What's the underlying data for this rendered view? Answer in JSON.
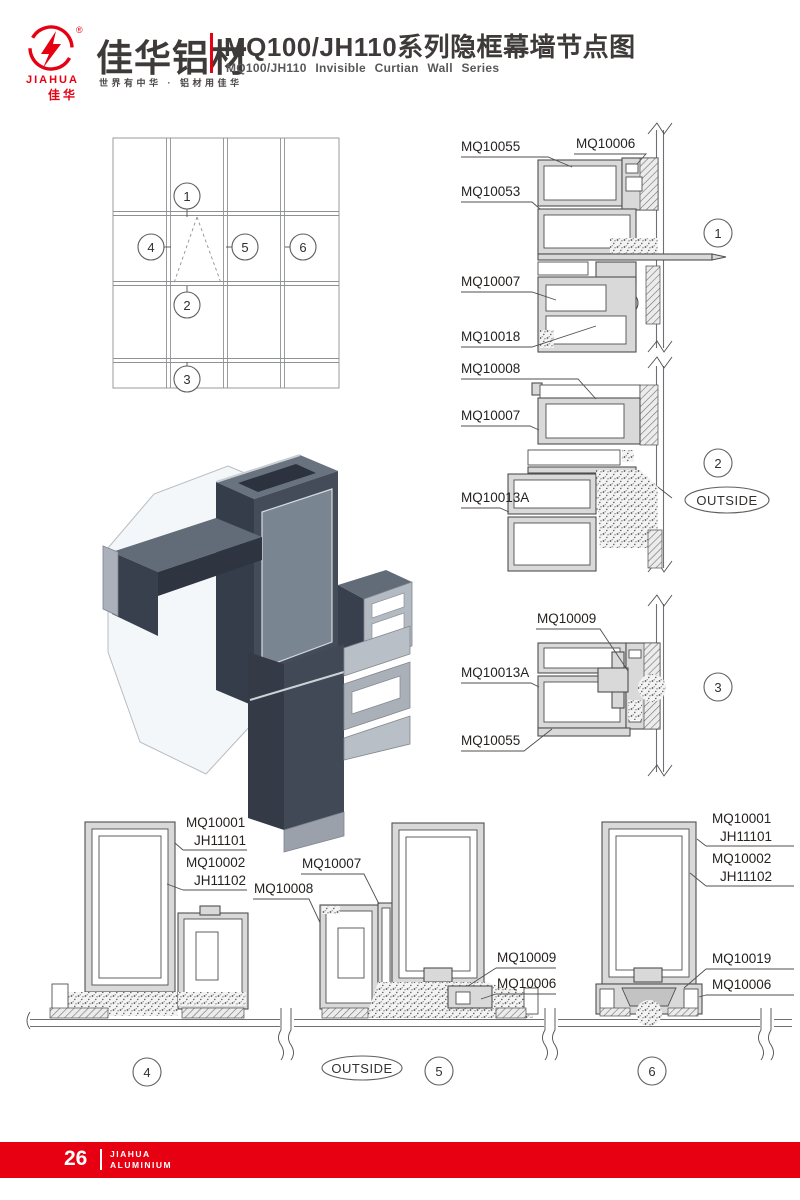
{
  "header": {
    "logo": {
      "brand_en": "JIAHUA",
      "brand_cn": "佳华",
      "registered": "®"
    },
    "brand_title": "佳华铝材",
    "brand_tagline": "世界有中华 · 铝材用佳华",
    "page_title": "MQ100/JH110系列隐框幕墙节点图",
    "page_subtitle": "MQ100/JH110 Invisible Curtian Wall Series"
  },
  "elevation": {
    "callouts": [
      "1",
      "2",
      "3",
      "4",
      "5",
      "6"
    ]
  },
  "details": {
    "d1": {
      "number": "1",
      "labels": [
        "MQ10055",
        "MQ10006",
        "MQ10053",
        "MQ10007",
        "MQ10018"
      ]
    },
    "d2": {
      "number": "2",
      "outside": "OUTSIDE",
      "labels": [
        "MQ10008",
        "MQ10007",
        "MQ10013A"
      ]
    },
    "d3": {
      "number": "3",
      "labels": [
        "MQ10009",
        "MQ10013A",
        "MQ10055"
      ]
    },
    "d4": {
      "number": "4",
      "labels": [
        "MQ10001",
        "JH11101",
        "MQ10002",
        "JH11102",
        "MQ10008"
      ]
    },
    "d5": {
      "number": "5",
      "outside": "OUTSIDE",
      "labels": [
        "MQ10007",
        "MQ10009",
        "MQ10006"
      ]
    },
    "d6": {
      "number": "6",
      "labels": [
        "MQ10001",
        "JH11101",
        "MQ10002",
        "JH11102",
        "MQ10019",
        "MQ10006"
      ]
    }
  },
  "footer": {
    "page_number": "26",
    "brand_line1": "JIAHUA",
    "brand_line2": "ALUMINIUM"
  },
  "colors": {
    "brand_red": "#e60012",
    "ink": "#3e3a39"
  }
}
